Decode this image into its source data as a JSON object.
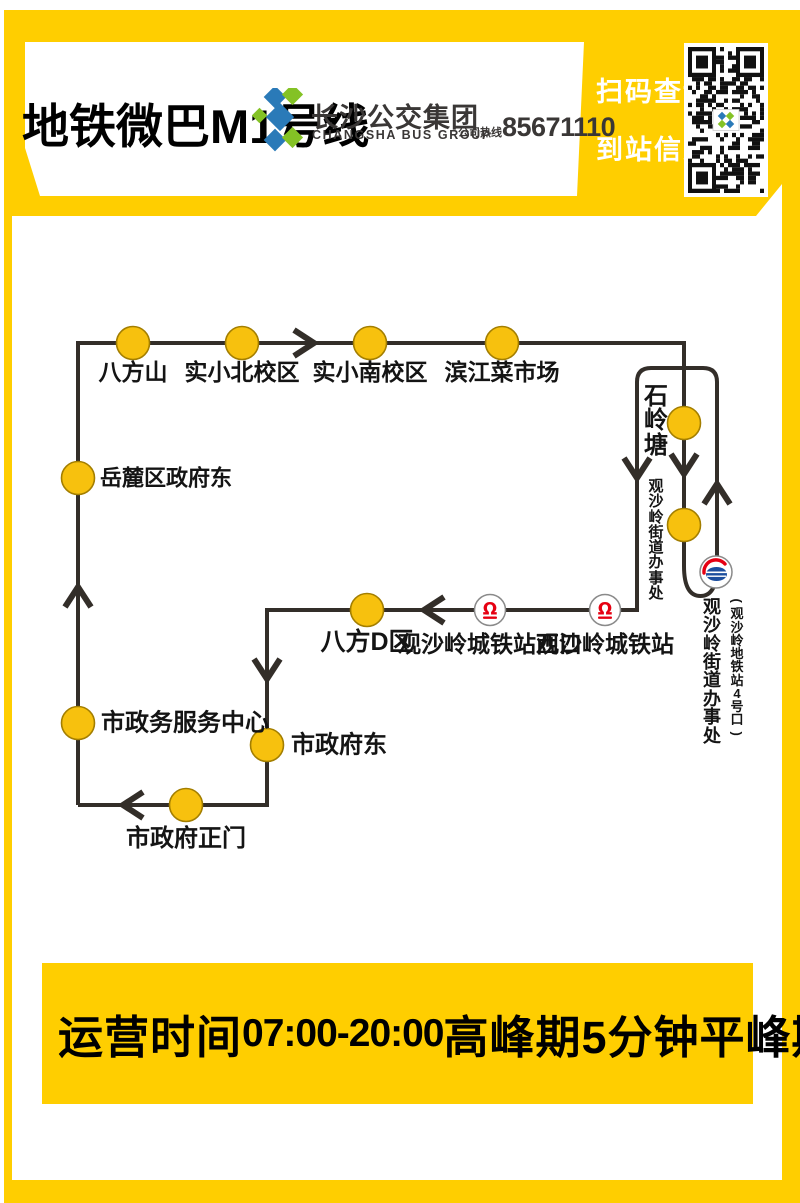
{
  "header": {
    "title": "地铁微巴M1号线",
    "brand_cn": "长沙公交集团",
    "brand_en": "CHANGSHA BUS GROUP",
    "hotline_label": "公司热线",
    "hotline_number": "85671110"
  },
  "qr": {
    "line1": "扫码查询",
    "line2": "到站信息"
  },
  "map": {
    "route_path": "M 78 805 L 78 343 L 684 343 L 684 566 Q 684 596 700.5 596 Q 717 596 717 566 L 717 382 Q 717 368 703 368 L 651 368 Q 637 368 637 382 L 637 610 L 267 610 L 267 805 L 78 805",
    "stations": [
      {
        "name": "八方山",
        "x": 133,
        "y": 343,
        "type": "stop",
        "label": {
          "mode": "below",
          "lx": 133,
          "ly": 360,
          "size": 23
        }
      },
      {
        "name": "实小北校区",
        "x": 242,
        "y": 343,
        "type": "stop",
        "label": {
          "mode": "below",
          "lx": 242,
          "ly": 360,
          "size": 23
        }
      },
      {
        "name": "实小南校区",
        "x": 370,
        "y": 343,
        "type": "stop",
        "label": {
          "mode": "below",
          "lx": 370,
          "ly": 360,
          "size": 23
        }
      },
      {
        "name": "滨江菜市场",
        "x": 502,
        "y": 343,
        "type": "stop",
        "label": {
          "mode": "below",
          "lx": 502,
          "ly": 360,
          "size": 23
        }
      },
      {
        "name": "石岭塘",
        "x": 684,
        "y": 423,
        "type": "stop",
        "label": {
          "mode": "vcol",
          "lx": 656,
          "ly": 385,
          "size": 24,
          "weight": 900
        }
      },
      {
        "name": "观沙岭街道办事处",
        "x": 684,
        "y": 525,
        "type": "stop",
        "label": {
          "mode": "vcol",
          "lx": 656,
          "ly": 479,
          "size": 15,
          "weight": 700
        }
      },
      {
        "name": "观沙岭城铁站",
        "x": 605,
        "y": 610,
        "type": "rail",
        "label": {
          "mode": "below",
          "lx": 605,
          "ly": 632,
          "size": 23
        }
      },
      {
        "name": "观沙岭城铁站西口",
        "x": 490,
        "y": 610,
        "type": "rail",
        "label": {
          "mode": "below",
          "lx": 490,
          "ly": 632,
          "size": 23
        }
      },
      {
        "name": "八方D区",
        "x": 367,
        "y": 610,
        "type": "stop",
        "label": {
          "mode": "below",
          "lx": 367,
          "ly": 629,
          "size": 25
        }
      },
      {
        "name": "市政府东",
        "x": 267,
        "y": 745,
        "type": "stop",
        "label": {
          "mode": "right",
          "lx": 291,
          "ly": 745,
          "size": 24
        }
      },
      {
        "name": "市政府正门",
        "x": 186,
        "y": 805,
        "type": "stop",
        "label": {
          "mode": "below",
          "lx": 186,
          "ly": 826,
          "size": 24
        }
      },
      {
        "name": "市政务服务中心",
        "x": 78,
        "y": 723,
        "type": "stop",
        "label": {
          "mode": "right",
          "lx": 101,
          "ly": 723,
          "size": 24
        }
      },
      {
        "name": "岳麓区政府东",
        "x": 78,
        "y": 478,
        "type": "stop",
        "label": {
          "mode": "right",
          "lx": 100,
          "ly": 478,
          "size": 22
        }
      }
    ],
    "terminus": {
      "main": {
        "text": "观沙岭街道办事处",
        "x": 712,
        "y": 598,
        "size": 18,
        "weight": 900
      },
      "sub": {
        "text": "(观沙岭地铁站4号口)",
        "x": 737,
        "y": 594,
        "size": 13,
        "weight": 700
      }
    },
    "metro_badge": {
      "x": 716,
      "y": 572
    },
    "arrows": [
      {
        "x": 303,
        "y": 343,
        "dir": "right"
      },
      {
        "x": 684,
        "y": 463,
        "dir": "down"
      },
      {
        "x": 637,
        "y": 467,
        "dir": "down"
      },
      {
        "x": 717,
        "y": 495,
        "dir": "up"
      },
      {
        "x": 435,
        "y": 610,
        "dir": "left"
      },
      {
        "x": 267,
        "y": 668,
        "dir": "down"
      },
      {
        "x": 134,
        "y": 805,
        "dir": "left"
      },
      {
        "x": 78,
        "y": 598,
        "dir": "up"
      }
    ]
  },
  "footer": {
    "label": "运营时间",
    "hours": "07:00-20:00",
    "peak": "高峰期5分钟",
    "offpeak": "平峰期15分钟"
  },
  "colors": {
    "yellow": "#FFCE00",
    "line": "#332E29",
    "stop_fill": "#F7C10E",
    "stop_stroke": "#A37E00",
    "rail_red": "#E60012",
    "metro_blue": "#1C4E9E",
    "brand_blue": "#2A7AB8",
    "brand_green": "#84C225"
  }
}
